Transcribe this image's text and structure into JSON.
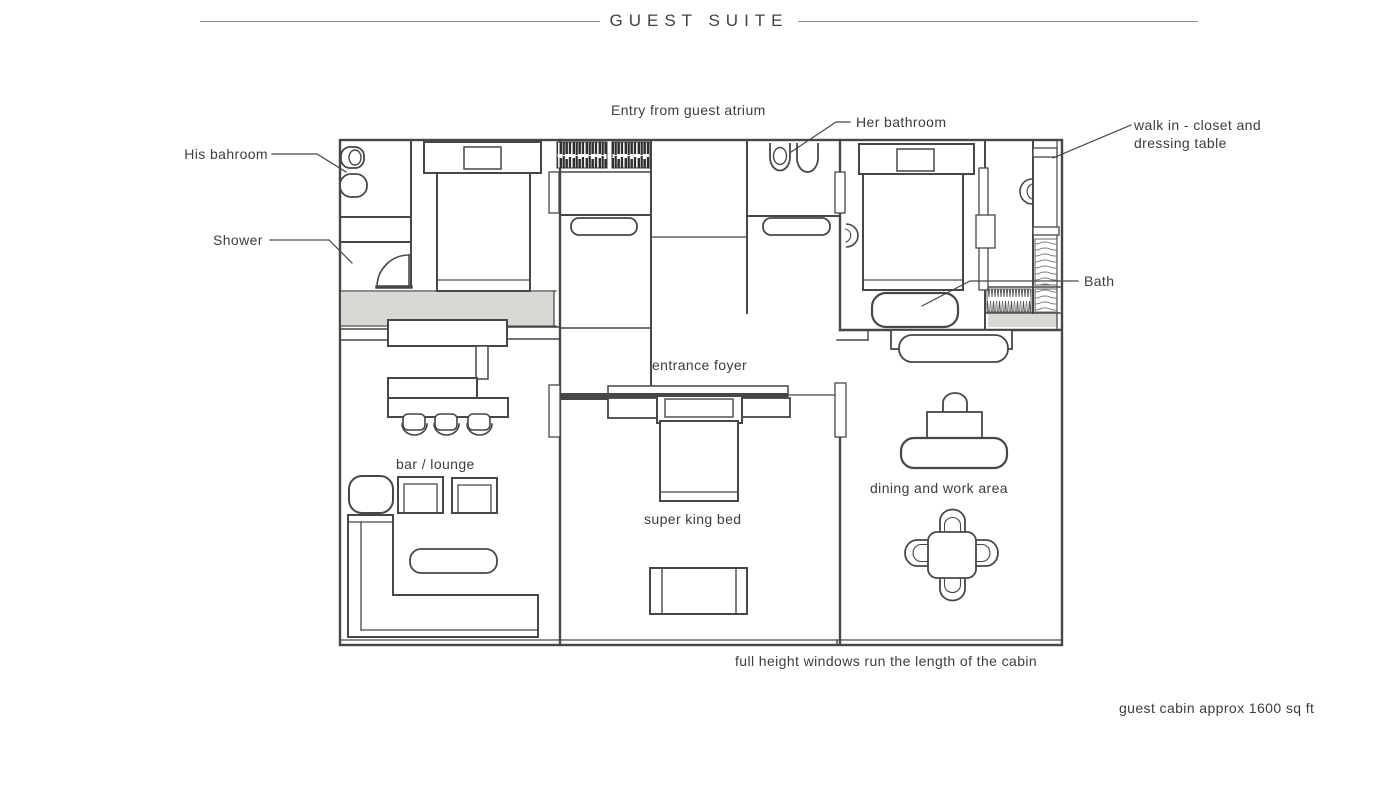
{
  "title": "GUEST SUITE",
  "labels": {
    "entry": "Entry from guest atrium",
    "his_bathroom": "His bahroom",
    "shower": "Shower",
    "her_bathroom": "Her bathroom",
    "walk_in_line1": "walk in - closet and",
    "walk_in_line2": "dressing table",
    "bath": "Bath",
    "entrance_foyer": "entrance foyer",
    "bar_lounge": "bar / lounge",
    "super_king_bed": "super king bed",
    "dining_work": "dining and work area",
    "windows_note": "full height windows run the length of the cabin",
    "cabin_area": "guest cabin approx 1600 sq ft"
  },
  "colors": {
    "ink": "#474747",
    "text": "#3d3d3d",
    "gray_fill": "#d9d8d5",
    "hatch_dark": "#2e2e2e",
    "title_line": "#8d8d8d"
  }
}
